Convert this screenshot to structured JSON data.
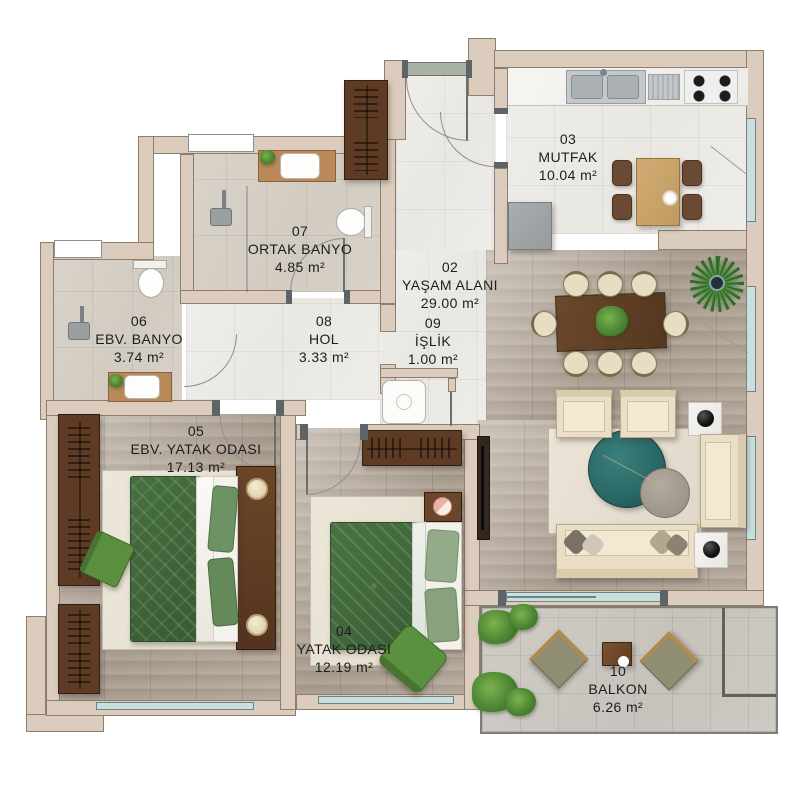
{
  "plan_title": "Apartment floor plan",
  "rooms": [
    {
      "num": "02",
      "name": "YAŞAM ALANI",
      "area": "29.00 m²"
    },
    {
      "num": "03",
      "name": "MUTFAK",
      "area": "10.04 m²"
    },
    {
      "num": "04",
      "name": "YATAK ODASI",
      "area": "12.19 m²"
    },
    {
      "num": "05",
      "name": "EBV. YATAK ODASI",
      "area": "17.13 m²"
    },
    {
      "num": "06",
      "name": "EBV. BANYO",
      "area": "3.74 m²"
    },
    {
      "num": "07",
      "name": "ORTAK BANYO",
      "area": "4.85 m²"
    },
    {
      "num": "08",
      "name": "HOL",
      "area": "3.33 m²"
    },
    {
      "num": "09",
      "name": "İŞLİK",
      "area": "1.00 m²"
    },
    {
      "num": "10",
      "name": "BALKON",
      "area": "6.26 m²"
    }
  ],
  "colors": {
    "wall": "#dbccbd",
    "wood_floor": "#ab9e90",
    "marble_floor": "#e9e7e2",
    "bath_tile": "#d1cbc1",
    "balcony_tile": "#c6c2bc",
    "bed_green": "#3f663c",
    "pillow_green": "#6d9263",
    "armchair_green": "#5a8f3f",
    "sofa_cream": "#eadfc6",
    "coffee_table_teal": "#2a6a68",
    "wardrobe_brown": "#5d3b25",
    "window_glass": "#c9dedd"
  }
}
